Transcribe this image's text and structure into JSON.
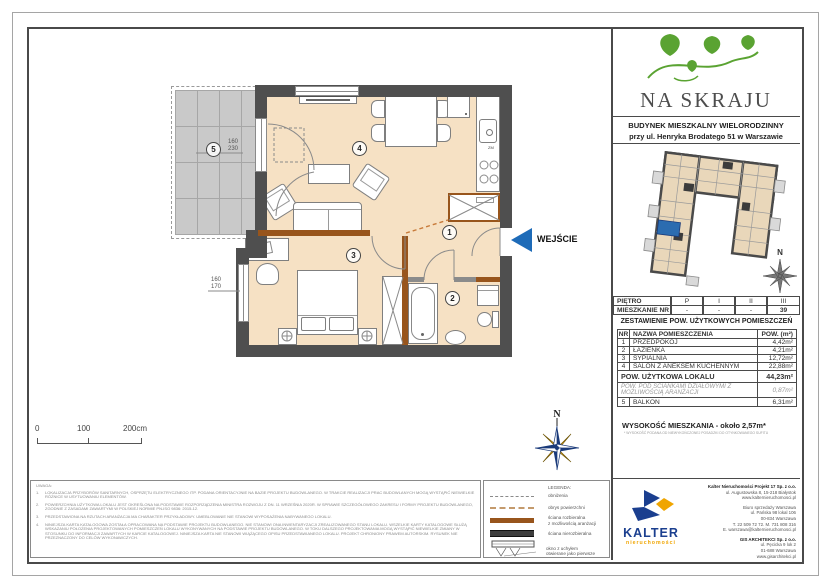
{
  "brand": {
    "logo_title": "NA SKRAJU",
    "building_line1": "BUDYNEK MIESZKALNY WIELORODZINNY",
    "building_line2": "przy ul. Henryka Brodatego 51 w Warszawie"
  },
  "plan": {
    "entrance_label": "WEJŚCIE",
    "north_label": "N",
    "kitchen_label": "ZM",
    "rooms": [
      {
        "num": "1"
      },
      {
        "num": "2"
      },
      {
        "num": "3"
      },
      {
        "num": "4"
      },
      {
        "num": "5"
      }
    ],
    "dims": {
      "balcony_door_w": "160",
      "balcony_door_h": "230",
      "bedroom_window_w": "160",
      "bedroom_window_h": "170"
    },
    "scalebar": {
      "t0": "0",
      "t1": "100",
      "t2": "200cm"
    }
  },
  "floor_table": {
    "row1": {
      "label": "PIĘTRO",
      "c1": "P",
      "c2": "I",
      "c3": "II",
      "c4": "III"
    },
    "row2": {
      "label": "MIESZKANIE NR",
      "c1": "-",
      "c2": "-",
      "c3": "-",
      "c4": "39"
    }
  },
  "area_table": {
    "title": "ZESTAWIENIE POW. UŻYTKOWYCH POMIESZCZEŃ",
    "head": {
      "nr": "NR",
      "name": "NAZWA POMIESZCZENIA",
      "area": "POW. (m²)"
    },
    "rows": [
      {
        "nr": "1",
        "name": "PRZEDPOKÓJ",
        "area": "4,42m²"
      },
      {
        "nr": "2",
        "name": "ŁAZIENKA",
        "area": "4,21m²"
      },
      {
        "nr": "3",
        "name": "SYPIALNIA",
        "area": "12,72m²"
      },
      {
        "nr": "4",
        "name": "SALON Z ANEKSEM KUCHENNYM",
        "area": "22,88m²"
      }
    ],
    "summary": {
      "name": "POW. UŻYTKOWA LOKALU",
      "area": "44,23m²"
    },
    "partition": {
      "name": "POW. POD ŚCIANKAMI DZIAŁOWYMI Z MOŻLIWOŚCIĄ ARANŻACJI",
      "area": "0,87m²"
    },
    "balcony": {
      "nr": "5",
      "name": "BALKON",
      "area": "6,31m²"
    },
    "height_line": "WYSOKOŚĆ MIESZKANIA - około 2,57m*",
    "height_footnote": "* WYSOKOŚĆ PODANA OD NIEWYKOŃCZONEJ POSADZKI DO OTYNKOWANEGO SUFITU"
  },
  "legend": {
    "title": "LEGENDA:",
    "items": [
      {
        "label": "obniżenia"
      },
      {
        "label": "obrys powierzchni"
      },
      {
        "label": "ściana rozbieralna",
        "label2": "z możliwością aranżacji"
      },
      {
        "label": "ściana nierozbieralna"
      },
      {
        "label": "okno z uchyłem",
        "label2": "otwierane jako pierwsze"
      }
    ]
  },
  "notes": {
    "title": "UWAGA:",
    "items": [
      {
        "num": "1.",
        "text": "LOKALIZACJA PRZYBORÓW SANITARNYCH, OSPRZĘTU ELEKTRYCZNEGO ITP. PODANA ORIENTACYJNIE NA BAZIE PROJEKTU BUDOWLANEGO. W TRAKCIE REALIZACJI PRAC BUDOWLANYCH MOGĄ WYSTĄPIĆ NIEWIELKIE RÓŻNICE W USYTUOWANIU ELEMENTÓW."
      },
      {
        "num": "2.",
        "text": "POWIERZCHNIA UŻYTKOWA LOKALU JEST OKREŚLONA NA PODSTAWIE ROZPORZĄDZENIA MINISTRA ROZWOJU Z DN. 11 WRZEŚNIA 2020R. W SPRAWIE SZCZEGÓŁOWEGO ZAKRESU I FORMY PROJEKTU BUDOWLANEGO, ZGODNIE Z ZASADAMI ZAWARTYMI W POLSKIEJ NORMIE PN-ISO 9836: 2015-12."
      },
      {
        "num": "3.",
        "text": "PRZEDSTAWIONA NA RZUTACH ARANŻACJA MA CHARAKTER PRZYKŁADOWY. UMEBLOWANIE NIE STANOWI WYPOSAŻENIA NABYWANEGO LOKALU."
      },
      {
        "num": "4.",
        "text": "NINIEJSZA KARTA KATALOGOWA ZOSTAŁA OPRACOWANA NA PODSTAWIE PROJEKTU BUDOWLANEGO. NIE STANOWI ONA INWENTARYZACJI ZREALIZOWANEGO STANU LOKALU. WSZELKIE KARTY KATALOGOWE SŁUŻĄ WSKAZANIU POŁOŻENIA PROJEKTOWANYCH POMIESZCZEŃ LOKALU WYKONYWANYCH NA PODSTAWIE PROJEKTU BUDOWLANEGO. W TOKU DALSZEGO PROJEKTOWANIA MOGĄ WYSTĄPIĆ NIEWIELKIE ZMIANY W STOSUNKU DO INFORMACJI ZAWARTYCH W KARCIE KATALOGOWEJ. NINIEJSZA KARTA NIE STANOWI WIĄŻĄCEGO OPISU PRZEDSTAWIANEGO LOKALU. PROJEKT CHRONIONY PRAWEM AUTORSKIM. RYSUNEK NIE PRZEZNACZONY DO CELÓW WYKONAWCZYCH."
      }
    ]
  },
  "company": {
    "kalter_name": "KALTER",
    "kalter_sub": "nieruchomości",
    "line1": "Kalter Nieruchomości Projekt 17 Sp. z o.o.",
    "line2": "ul. Augustowska 8, 15-218 Białystok",
    "line3": "www.kalternieruchomosci.pl",
    "line4": "Biuro sprzedaży Warszawa",
    "line5": "ul. Pańska 98 lokal 106",
    "line6": "00-834 Warszawa",
    "line7": "T. 22 509 72 72. M. 731 808 316",
    "line8": "E. warszawa@kalternieruchomosci.pl",
    "line9": "GIS ARCHITEKCI Sp. z o.o.",
    "line10": "ul. Pęcicka 9 lok 2",
    "line11": "01-688 Warszawa",
    "line12": "www.gisarchitekci.pl"
  },
  "colors": {
    "accent_blue": "#1e6bb8",
    "wall_dark": "#4f4f4f",
    "wall_brown": "#98551c",
    "floor_beige": "#f6e1c4",
    "logo_green": "#5aa332",
    "kalter_blue": "#1b3f8f",
    "kalter_yellow": "#f0a500"
  }
}
